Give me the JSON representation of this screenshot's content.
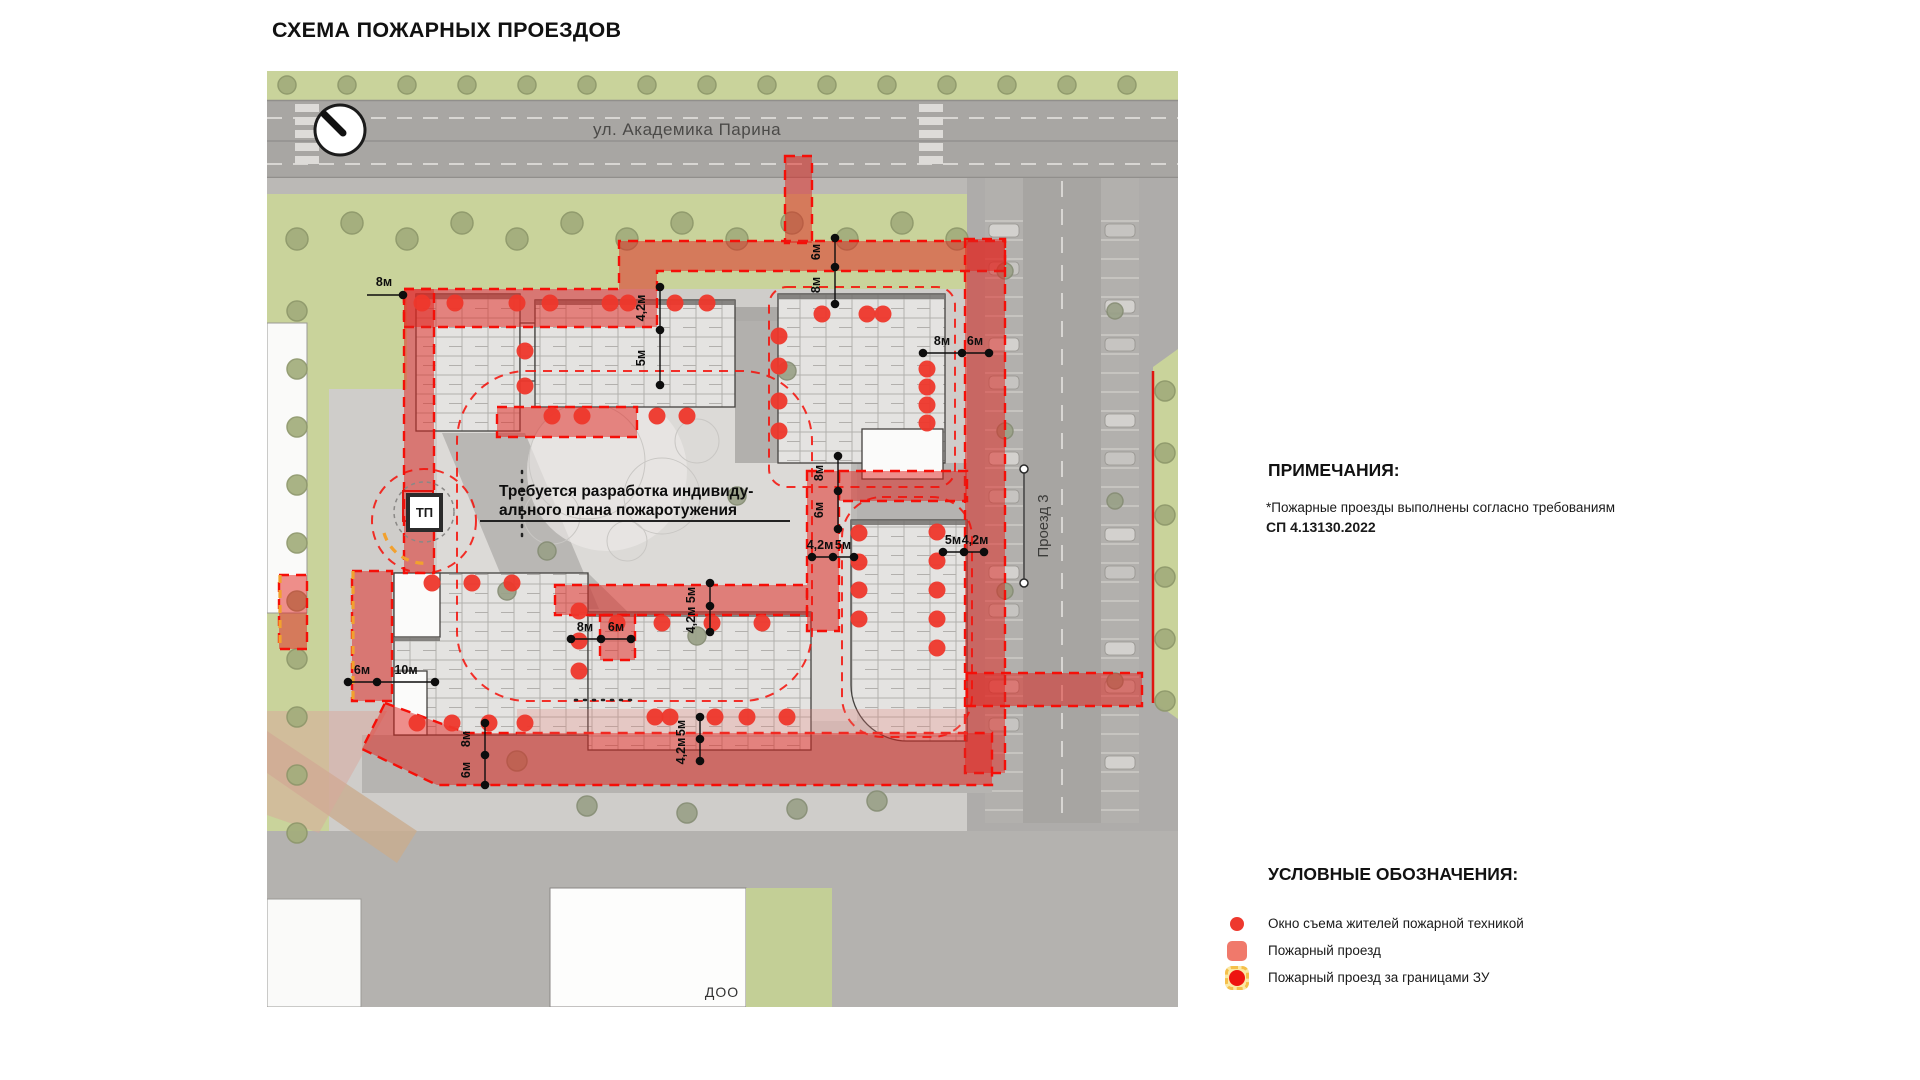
{
  "page": {
    "title": "СХЕМА ПОЖАРНЫХ ПРОЕЗДОВ"
  },
  "map": {
    "street_top": "ул. Академика Парина",
    "street_right": "Проезд 3",
    "doo_label": "ДОО",
    "tp_label": "ТП",
    "annotation": {
      "line1": "Требуется разработка индивиду-",
      "line2": "ального плана пожаротужения"
    },
    "dimensions": [
      {
        "t": "4,2м",
        "x": 378,
        "y": 237,
        "v": 1
      },
      {
        "t": "5м",
        "x": 378,
        "y": 287,
        "v": 1
      },
      {
        "t": "6м",
        "x": 553,
        "y": 181,
        "v": 1
      },
      {
        "t": "8м",
        "x": 553,
        "y": 214,
        "v": 1
      },
      {
        "t": "8м",
        "x": 556,
        "y": 402,
        "v": 1
      },
      {
        "t": "6м",
        "x": 556,
        "y": 439,
        "v": 1
      },
      {
        "t": "5м",
        "x": 428,
        "y": 524,
        "v": 1
      },
      {
        "t": "4,2м",
        "x": 428,
        "y": 549,
        "v": 1
      },
      {
        "t": "5м",
        "x": 418,
        "y": 657,
        "v": 1
      },
      {
        "t": "4,2м",
        "x": 418,
        "y": 680,
        "v": 1
      },
      {
        "t": "8м",
        "x": 203,
        "y": 668,
        "v": 1
      },
      {
        "t": "6м",
        "x": 203,
        "y": 699,
        "v": 1
      },
      {
        "t": "8м",
        "x": 675,
        "y": 274,
        "v": 0
      },
      {
        "t": "6м",
        "x": 708,
        "y": 274,
        "v": 0
      },
      {
        "t": "4,2м",
        "x": 553,
        "y": 478,
        "v": 0
      },
      {
        "t": "5м",
        "x": 576,
        "y": 478,
        "v": 0
      },
      {
        "t": "5м",
        "x": 686,
        "y": 473,
        "v": 0
      },
      {
        "t": "4,2м",
        "x": 708,
        "y": 473,
        "v": 0
      },
      {
        "t": "8м",
        "x": 318,
        "y": 560,
        "v": 0
      },
      {
        "t": "6м",
        "x": 349,
        "y": 560,
        "v": 0
      },
      {
        "t": "6м",
        "x": 95,
        "y": 603,
        "v": 0
      },
      {
        "t": "10м",
        "x": 139,
        "y": 603,
        "v": 0
      },
      {
        "t": "8м",
        "x": 117,
        "y": 215,
        "v": 0
      }
    ],
    "dim_lines": [
      [
        393,
        216,
        393,
        314
      ],
      [
        568,
        167,
        568,
        233
      ],
      [
        571,
        385,
        571,
        458
      ],
      [
        443,
        512,
        443,
        561
      ],
      [
        433,
        646,
        433,
        690
      ],
      [
        218,
        652,
        218,
        714
      ],
      [
        656,
        282,
        722,
        282
      ],
      [
        545,
        486,
        587,
        486
      ],
      [
        676,
        481,
        717,
        481
      ],
      [
        304,
        568,
        364,
        568
      ],
      [
        81,
        611,
        168,
        611
      ],
      [
        100,
        224,
        136,
        224
      ]
    ],
    "dim_dots": [
      [
        393,
        216
      ],
      [
        393,
        259
      ],
      [
        393,
        314
      ],
      [
        568,
        167
      ],
      [
        568,
        196
      ],
      [
        568,
        233
      ],
      [
        571,
        385
      ],
      [
        571,
        420
      ],
      [
        571,
        458
      ],
      [
        443,
        512
      ],
      [
        443,
        535
      ],
      [
        443,
        561
      ],
      [
        433,
        646
      ],
      [
        433,
        668
      ],
      [
        433,
        690
      ],
      [
        218,
        652
      ],
      [
        218,
        684
      ],
      [
        218,
        714
      ],
      [
        656,
        282
      ],
      [
        695,
        282
      ],
      [
        722,
        282
      ],
      [
        545,
        486
      ],
      [
        566,
        486
      ],
      [
        587,
        486
      ],
      [
        676,
        481
      ],
      [
        697,
        481
      ],
      [
        717,
        481
      ],
      [
        304,
        568
      ],
      [
        334,
        568
      ],
      [
        364,
        568
      ],
      [
        81,
        611
      ],
      [
        110,
        611
      ],
      [
        168,
        611
      ],
      [
        136,
        224
      ]
    ],
    "rescue_windows": [
      [
        155,
        232
      ],
      [
        188,
        232
      ],
      [
        250,
        232
      ],
      [
        283,
        232
      ],
      [
        343,
        232
      ],
      [
        361,
        232
      ],
      [
        408,
        232
      ],
      [
        440,
        232
      ],
      [
        285,
        345
      ],
      [
        315,
        345
      ],
      [
        390,
        345
      ],
      [
        420,
        345
      ],
      [
        258,
        280
      ],
      [
        258,
        315
      ],
      [
        555,
        243
      ],
      [
        600,
        243
      ],
      [
        616,
        243
      ],
      [
        512,
        265
      ],
      [
        512,
        295
      ],
      [
        512,
        330
      ],
      [
        512,
        360
      ],
      [
        660,
        298
      ],
      [
        660,
        316
      ],
      [
        660,
        334
      ],
      [
        660,
        352
      ],
      [
        165,
        512
      ],
      [
        205,
        512
      ],
      [
        245,
        512
      ],
      [
        312,
        540
      ],
      [
        312,
        570
      ],
      [
        312,
        600
      ],
      [
        150,
        652
      ],
      [
        185,
        652
      ],
      [
        222,
        652
      ],
      [
        258,
        652
      ],
      [
        350,
        552
      ],
      [
        395,
        552
      ],
      [
        445,
        552
      ],
      [
        495,
        552
      ],
      [
        388,
        646
      ],
      [
        403,
        646
      ],
      [
        448,
        646
      ],
      [
        480,
        646
      ],
      [
        520,
        646
      ],
      [
        592,
        462
      ],
      [
        592,
        491
      ],
      [
        592,
        519
      ],
      [
        592,
        548
      ],
      [
        670,
        461
      ],
      [
        670,
        490
      ],
      [
        670,
        519
      ],
      [
        670,
        548
      ],
      [
        670,
        577
      ]
    ]
  },
  "notes": {
    "heading": "ПРИМЕЧАНИЯ:",
    "body": "*Пожарные проезды выполнены согласно требованиям",
    "code": "СП 4.13130.2022"
  },
  "legend": {
    "heading": "УСЛОВНЫЕ ОБОЗНАЧЕНИЯ:",
    "items": [
      {
        "icon": "rescue-window-dot-icon",
        "label": "Окно съема жителей пожарной техникой"
      },
      {
        "icon": "fire-lane-icon",
        "label": "Пожарный проезд"
      },
      {
        "icon": "fire-lane-outside-boundary-icon",
        "label": "Пожарный проезд за границами ЗУ"
      }
    ]
  },
  "colors": {
    "fire_red": "#ee2b22",
    "fire_fill": "rgba(225,34,27,0.5)",
    "boundary_orange": "#f2a12e",
    "green": "#c9d39b",
    "road_gray": "#a8a6a3"
  }
}
